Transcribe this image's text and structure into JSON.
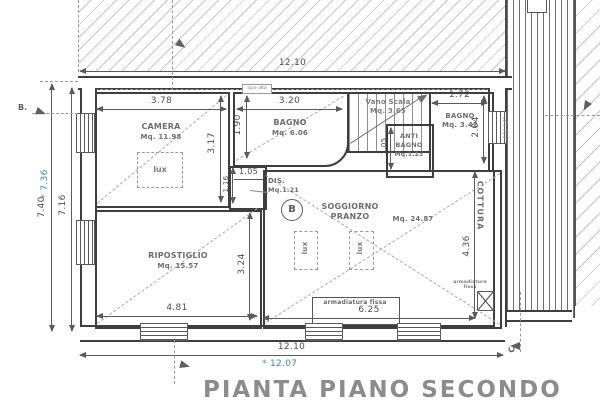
{
  "title": "PIANTA PIANO SECONDO",
  "marker_star": "*",
  "rooms": {
    "camera": {
      "name": "CAMERA",
      "area": "Mq. 11.98"
    },
    "bagno1": {
      "name": "BAGNO",
      "area": "Mq. 6.06"
    },
    "vano_scala": {
      "name": "Vano Scala",
      "area": "Mq. 3.65"
    },
    "bagno2": {
      "name": "BAGNO",
      "area": "Mq. 3.42"
    },
    "anti_bagno": {
      "line1": "ANTI",
      "line2": "BAGNO",
      "area": "Mq.1.23"
    },
    "dis": {
      "name": "DIS.",
      "area": "Mq.1.21"
    },
    "soggiorno": {
      "line1": "SOGGIORNO",
      "line2": "PRANZO",
      "area": "Mq. 24.87"
    },
    "ripostiglio": {
      "name": "RIPOSTIGLIO",
      "area": "Mq. 15.57"
    }
  },
  "dims": {
    "top_width": "12.10",
    "bottom_width": "12.10",
    "left_outer": "7.40",
    "left_inner": "7.16",
    "camera_w": "3.78",
    "camera_h": "3.17",
    "bagno1_w": "3.20",
    "bagno1_h": "1.90",
    "bagno2_w": "1.72",
    "bagno2_h": "2.04",
    "anti_h": "1.05",
    "dis_w": "1.05",
    "dis_h": "1.16",
    "rip_w": "4.81",
    "rip_h": "3.24",
    "sog_w": "6.25",
    "sog_h": "4.36"
  },
  "blue": {
    "width": "12.07",
    "height": "7.36"
  },
  "annotations": {
    "lux": "lux",
    "luce_alta": "luce alta",
    "cottura": "COTTURA",
    "armadiatura": "armadiatura fissa",
    "armadiatura_small_1": "armadiatura",
    "armadiatura_small_2": "fissa",
    "stair_note": "0.93 0.90"
  },
  "markers": {
    "b_side": "B.",
    "b_circle": "B",
    "c": "C"
  }
}
